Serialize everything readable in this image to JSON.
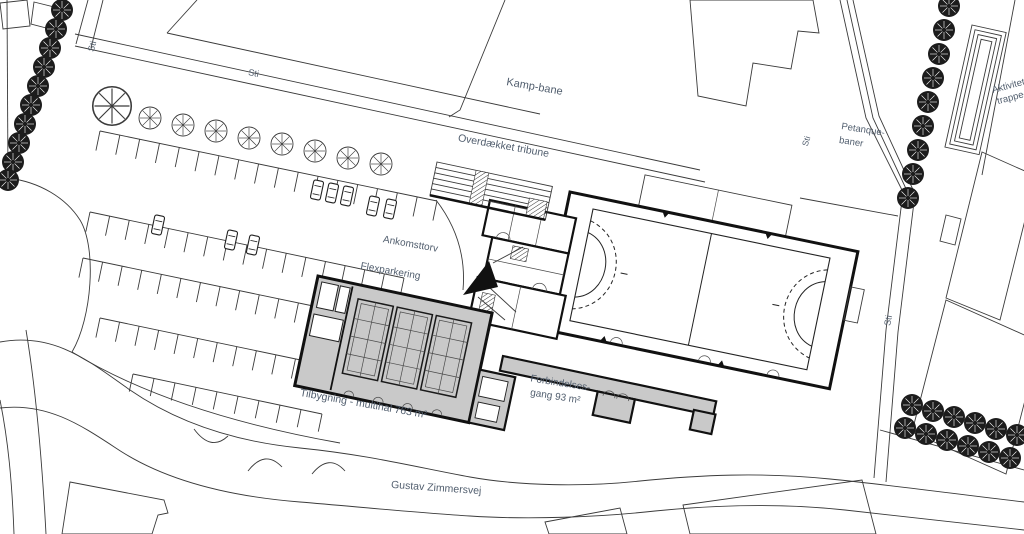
{
  "plan": {
    "labels": {
      "sti_nw": "Sti",
      "sti_top": "Sti",
      "kamp_bane": "Kamp-bane",
      "overdaekket_tribune": "Overdækket tribune",
      "petanque_line1": "Petanque-",
      "petanque_line2": "baner",
      "sti_petanque": "Sti",
      "sti_east": "Sti",
      "aktivitets_line1": "Aktivitets-",
      "aktivitets_line2": "trappe-",
      "ankomsttorv": "Ankomsttorv",
      "flexparkering": "Flexparkering",
      "tilbygning": "Tilbygning - multihal 763 m²",
      "forbindelses_line1": "Forbindelses-",
      "forbindelses_line2": "gang 93 m²",
      "gustav_zimmersvej": "Gustav Zimmersvej"
    },
    "colors": {
      "background": "#ffffff",
      "new_building_fill": "#c9c9c9",
      "line": "#3a3a3a",
      "wall": "#111111",
      "label_text": "#515e6e",
      "tree_dark": "#1c1c1c"
    }
  }
}
